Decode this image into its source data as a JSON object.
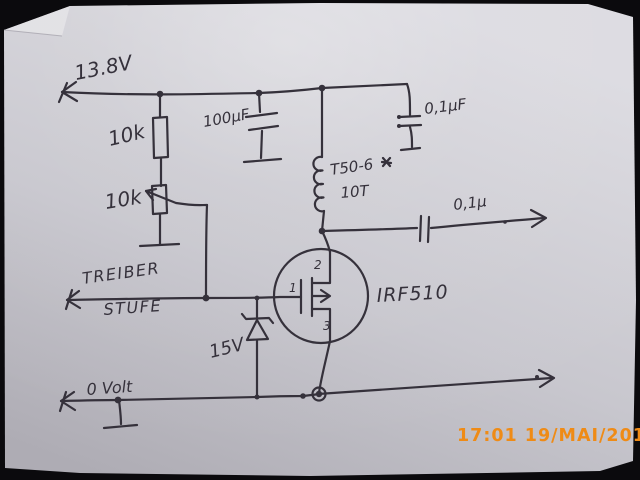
{
  "photo": {
    "timestamp": "17:01 19/MAI/2017",
    "description": "hand-drawn MOSFET driver stage schematic on paper"
  },
  "colors": {
    "background": "#0b0a0d",
    "paper": "#cbcad1",
    "paper_bright": "#dcdbe1",
    "paper_shadow": "#aaa8b0",
    "ink": "#35313b",
    "timestamp": "#ef8b16"
  },
  "labels": {
    "supply": "13.8V",
    "resistor_top": "10k",
    "potentiometer": "10k",
    "bulk_cap": "100µF",
    "bypass_cap": "0,1µF",
    "toroid_core": "T50-6",
    "toroid_turns": "10T",
    "output_cap": "0,1µ",
    "input_line1": "TREIBER",
    "input_line2": "STUFE",
    "mosfet": "IRF510",
    "zener": "15V",
    "ground_rail": "0 Volt",
    "pin_gate": "1",
    "pin_drain": "2",
    "pin_source": "3"
  }
}
